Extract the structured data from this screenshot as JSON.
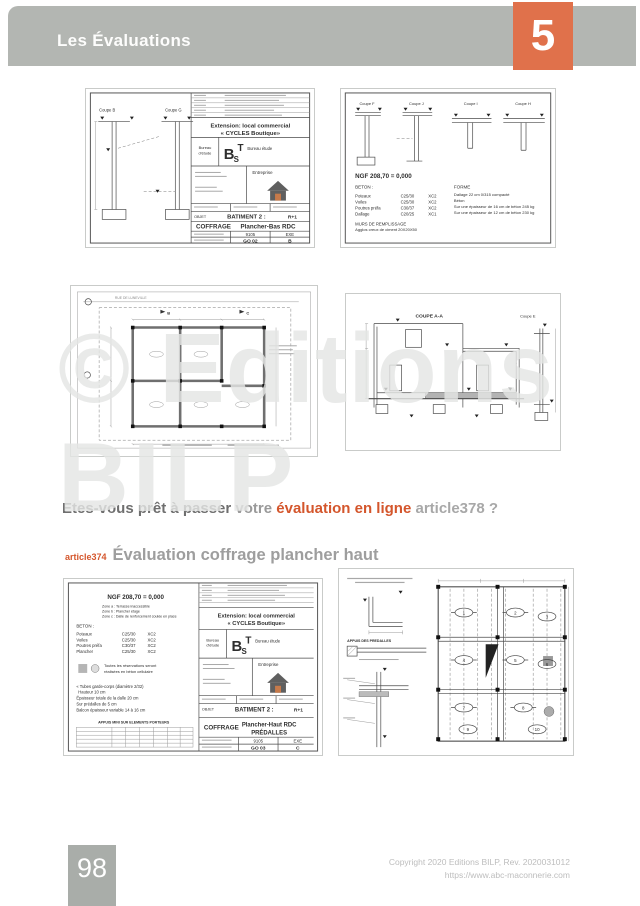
{
  "header": {
    "title": "Les Évaluations",
    "chapter": "5"
  },
  "watermark": {
    "line1": "© Editions",
    "line2": "BILP"
  },
  "question": {
    "p1": "Etes-vous prêt à passer",
    "p2": "votre",
    "p3": "évaluation en ligne",
    "p4": "article378 ?"
  },
  "section": {
    "ref": "article374",
    "title": "Évaluation coffrage plancher haut"
  },
  "footer": {
    "page_number": "98",
    "copyright1": "Copyright 2020 Editions BILP, Rev. 2020031012",
    "copyright2": "https://www.abc-maconnerie.com"
  },
  "colors": {
    "accent_orange": "#e0714b",
    "header_bar_gray": "#b3b6b2",
    "ref_orange": "#d4562c"
  },
  "drawings": {
    "d1": {
      "coupe_left": "Coupe B",
      "coupe_right": "Coupe G",
      "tb": {
        "project1": "Extension: local commercial",
        "project2": "« CYCLES Boutique»",
        "bureau1": "Bureau",
        "bureau2": "d'étude",
        "logo_b": "B",
        "logo_s": "S",
        "logo_t": "T",
        "bureau_name": "Bureau étude",
        "entreprise": "Entreprise",
        "objet": "OBJET",
        "batiment": "BATIMENT 2 :",
        "niveau": "R+1",
        "type": "COFFRAGE",
        "plan": "Plancher-Bas  RDC",
        "num": "9105",
        "phase": "EXE",
        "code": "GO 02",
        "indice": "B"
      }
    },
    "d2": {
      "coupes": [
        "Coupe F",
        "Coupe J",
        "Coupe I",
        "Coupe H"
      ],
      "ngf": "NGF 208,70 = 0,000",
      "beton_title": "BETON :",
      "beton_rows": [
        [
          "Poteaux",
          "C25/30",
          "XC2"
        ],
        [
          "Voiles",
          "C25/30",
          "XC2"
        ],
        [
          "Poutres préfa",
          "C30/37",
          "XC2"
        ],
        [
          "Dallage",
          "C20/25",
          "XC1"
        ]
      ],
      "murs1": "MURS DE REMPLISSAGE",
      "murs2": "Agglos creux de ciment 20X20X50",
      "forme_title": "FORME",
      "forme_lines": [
        "Dallage 22 cm 0/315 compacté",
        "Béton",
        "Sur une épaisseur de 16 cm de béton 245 kg",
        "Sur une épaisseur de 12 cm de béton 230 kg"
      ]
    },
    "d3": {
      "street": "RUE DE LUNEVILLE",
      "mark_b": "B",
      "mark_c": "C"
    },
    "d4": {
      "coupe_main": "COUPE A-A",
      "coupe_right": "Coupe E"
    },
    "d5": {
      "ngf": "NGF 208,70 = 0,000",
      "zones": [
        "Zone a : Terrasse inaccessible",
        "Zone b : Plancher étage",
        "Zone c : Dalle de renforcement coulée en place"
      ],
      "beton_title": "BETON :",
      "beton_rows": [
        [
          "Poteaux",
          "C25/30",
          "XC2"
        ],
        [
          "Voiles",
          "C25/30",
          "XC2"
        ],
        [
          "Poutres préfa",
          "C30/37",
          "XC2"
        ],
        [
          "Plancher",
          "C25/30",
          "XC2"
        ]
      ],
      "note1": "Toutes les réservations seront",
      "note2": "réalisées en béton cellulaire",
      "specs": [
        "« Tubes garde-corps (diamètre 2/32)",
        "Hauteur 10 cm",
        "Épaisseur totale de la dalle 20 cm",
        "Sur prédalles de 5 cm",
        "Balcon épaisseur variable 14 à 16 cm"
      ],
      "appuis": "APPUIS MINI SUR ELEMENTS PORTEURS",
      "tb": {
        "project1": "Extension: local commercial",
        "project2": "« CYCLES Boutique»",
        "bureau1": "Bureau",
        "bureau2": "d'étude",
        "logo_b": "B",
        "logo_s": "S",
        "logo_t": "T",
        "bureau_name": "Bureau étude",
        "entreprise": "Entreprise",
        "objet": "OBJET",
        "batiment": "BATIMENT 2 :",
        "niveau": "R+1",
        "type": "COFFRAGE",
        "plan1": "Plancher-Haut RDC",
        "plan2": "PRÉDALLES",
        "num": "9105",
        "phase": "EXE",
        "code": "GO 03",
        "indice": "C"
      }
    },
    "d6": {
      "appuis": "APPUIS DES PREDALLES",
      "panels": [
        "1",
        "2",
        "3",
        "4",
        "5",
        "6",
        "7",
        "8",
        "9",
        "10"
      ]
    }
  }
}
